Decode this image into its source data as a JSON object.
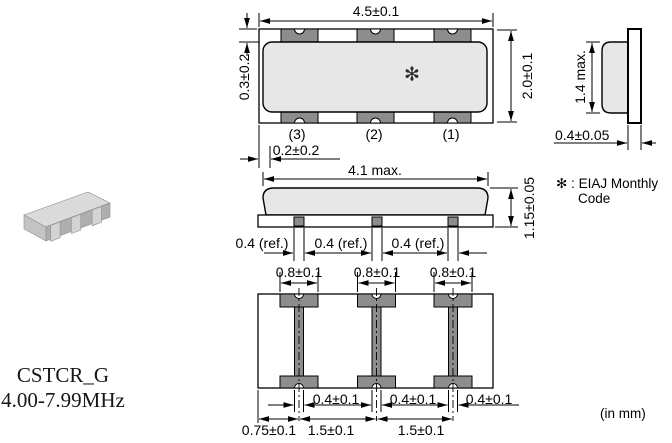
{
  "product": {
    "series": "CSTCR_G",
    "frequency_range": "4.00-7.99MHz"
  },
  "notes": {
    "marking_note_line1": "✻ : EIAJ Monthly",
    "marking_note_line2": "Code",
    "units": "(in mm)"
  },
  "top_view": {
    "dim_overall_width": "4.5±0.1",
    "dim_overall_height": "2.0±0.1",
    "dim_cap_offset_top": "0.3±0.2",
    "dim_cap_offset_side": "0.2±0.2",
    "terminal_labels": [
      "(3)",
      "(2)",
      "(1)"
    ],
    "marking": "✻"
  },
  "side_view": {
    "dim_max_height": "1.4 max.",
    "dim_substrate_thickness": "0.4±0.05"
  },
  "front_view": {
    "dim_cap_width": "4.1 max.",
    "dim_total_height": "1.15±0.05",
    "dim_terminal_widths": [
      "0.4 (ref.)",
      "0.4 (ref.)",
      "0.4 (ref.)"
    ]
  },
  "bottom_view": {
    "dim_pad_widths": [
      "0.8±0.1",
      "0.8±0.1",
      "0.8±0.1"
    ],
    "dim_electrode_widths": [
      "0.4±0.1",
      "0.4±0.1",
      "0.4±0.1"
    ],
    "dim_edge_to_first_electrode": "0.75±0.1",
    "dim_pitch": [
      "1.5±0.1",
      "1.5±0.1"
    ]
  },
  "colors": {
    "cap_gray": "#e7e7e7",
    "terminal_gray": "#8d8d8d",
    "line": "#000000"
  }
}
